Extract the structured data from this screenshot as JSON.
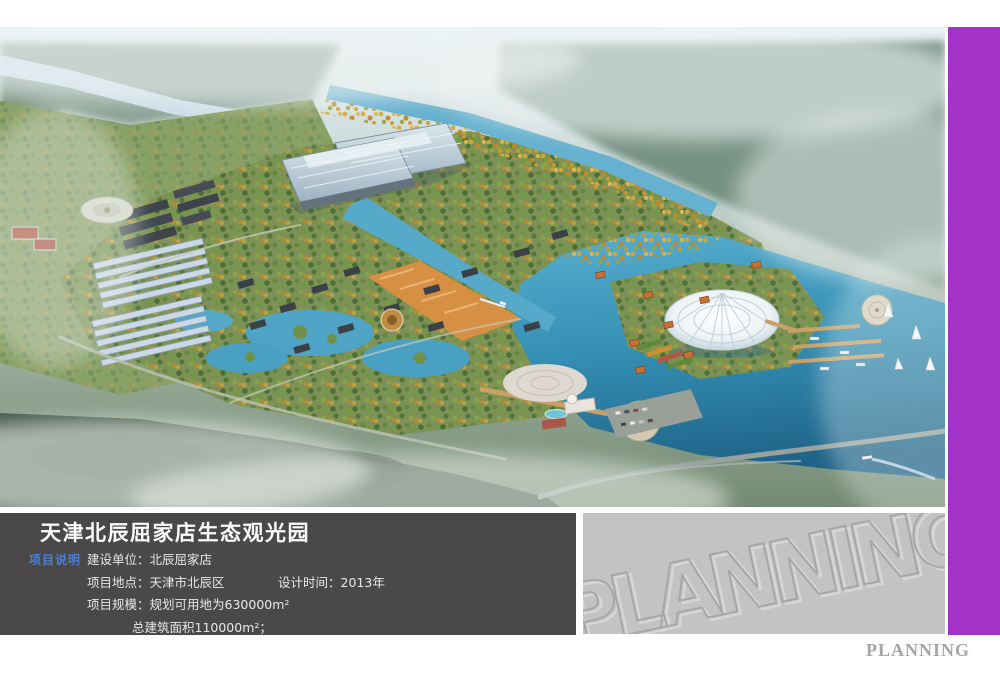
{
  "page": {
    "background": "#ffffff",
    "colors": {
      "side_stripe_purple": "#a232c8",
      "info_panel_bg": "#4a4849",
      "section_label_blue": "#4a7fd4",
      "watermark_panel_bg": "#c3c3c3",
      "footer_text_gray": "#a9a3a7",
      "lake_water_teal": "#3590b5"
    }
  },
  "info_panel": {
    "title": "天津北辰屈家店生态观光园",
    "section_label": "项目说明",
    "rows": [
      {
        "label": "建设单位：",
        "value": "北辰屈家店"
      },
      {
        "label": "项目地点：",
        "value": "天津市北辰区",
        "label2": "设计时间：",
        "value2": "2013年"
      },
      {
        "label": "项目规模：",
        "value": "规划可用地为630000m²"
      },
      {
        "value": "总建筑面积110000m²；"
      }
    ]
  },
  "watermark_panel": {
    "text": "PLANNING"
  },
  "footer": {
    "text": "PLANNING"
  }
}
